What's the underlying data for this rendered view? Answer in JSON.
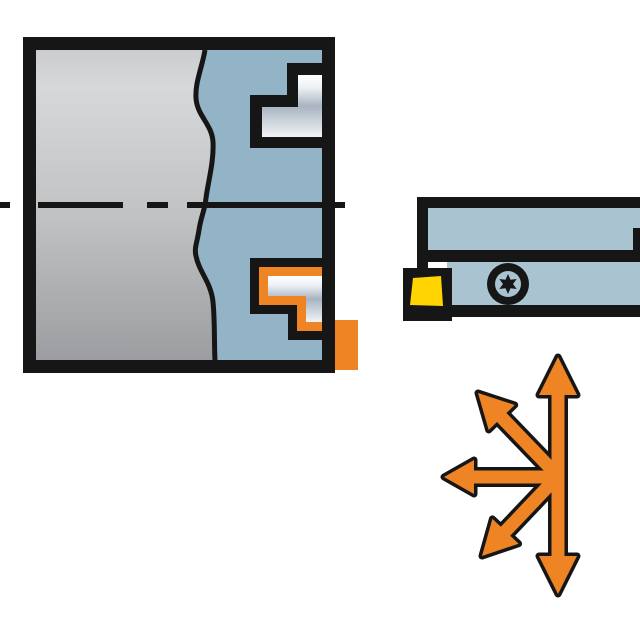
{
  "illustration": {
    "type": "technical-cutting-tool-diagram",
    "parts": {
      "workpiece": "workpiece-cross-section",
      "workpiece_body": "solid-bar-section",
      "bore_profile": "machined-internal-profile",
      "upper_feature": "machined-step-upper",
      "lower_feature": "machined-step-lower-highlighted",
      "centerline": "rotation-axis-centerline",
      "tool_holder": "turning-tool-holder",
      "insert": "cutting-insert",
      "screw": "torx-screw-icon",
      "arrows": "feed-direction-arrows-icon"
    },
    "arrow_directions": [
      "up",
      "down",
      "left",
      "up-left",
      "down-left"
    ]
  },
  "colors": {
    "outline": "#161616",
    "box_blue": "#93b3c6",
    "holder_blue": "#a9c4d0",
    "orange": "#ef8425",
    "yellow": "#ffd400",
    "gray_1": "#cbccce",
    "gray_2": "#d7d8da",
    "gray_3": "#bfc1c3",
    "gray_4": "#9b9da0",
    "metal_1": "#ffffff",
    "metal_2": "#eef1f4",
    "metal_3": "#a9b4c1",
    "metal_4": "#c8d0d8",
    "metal_5": "#f2f4f7"
  }
}
